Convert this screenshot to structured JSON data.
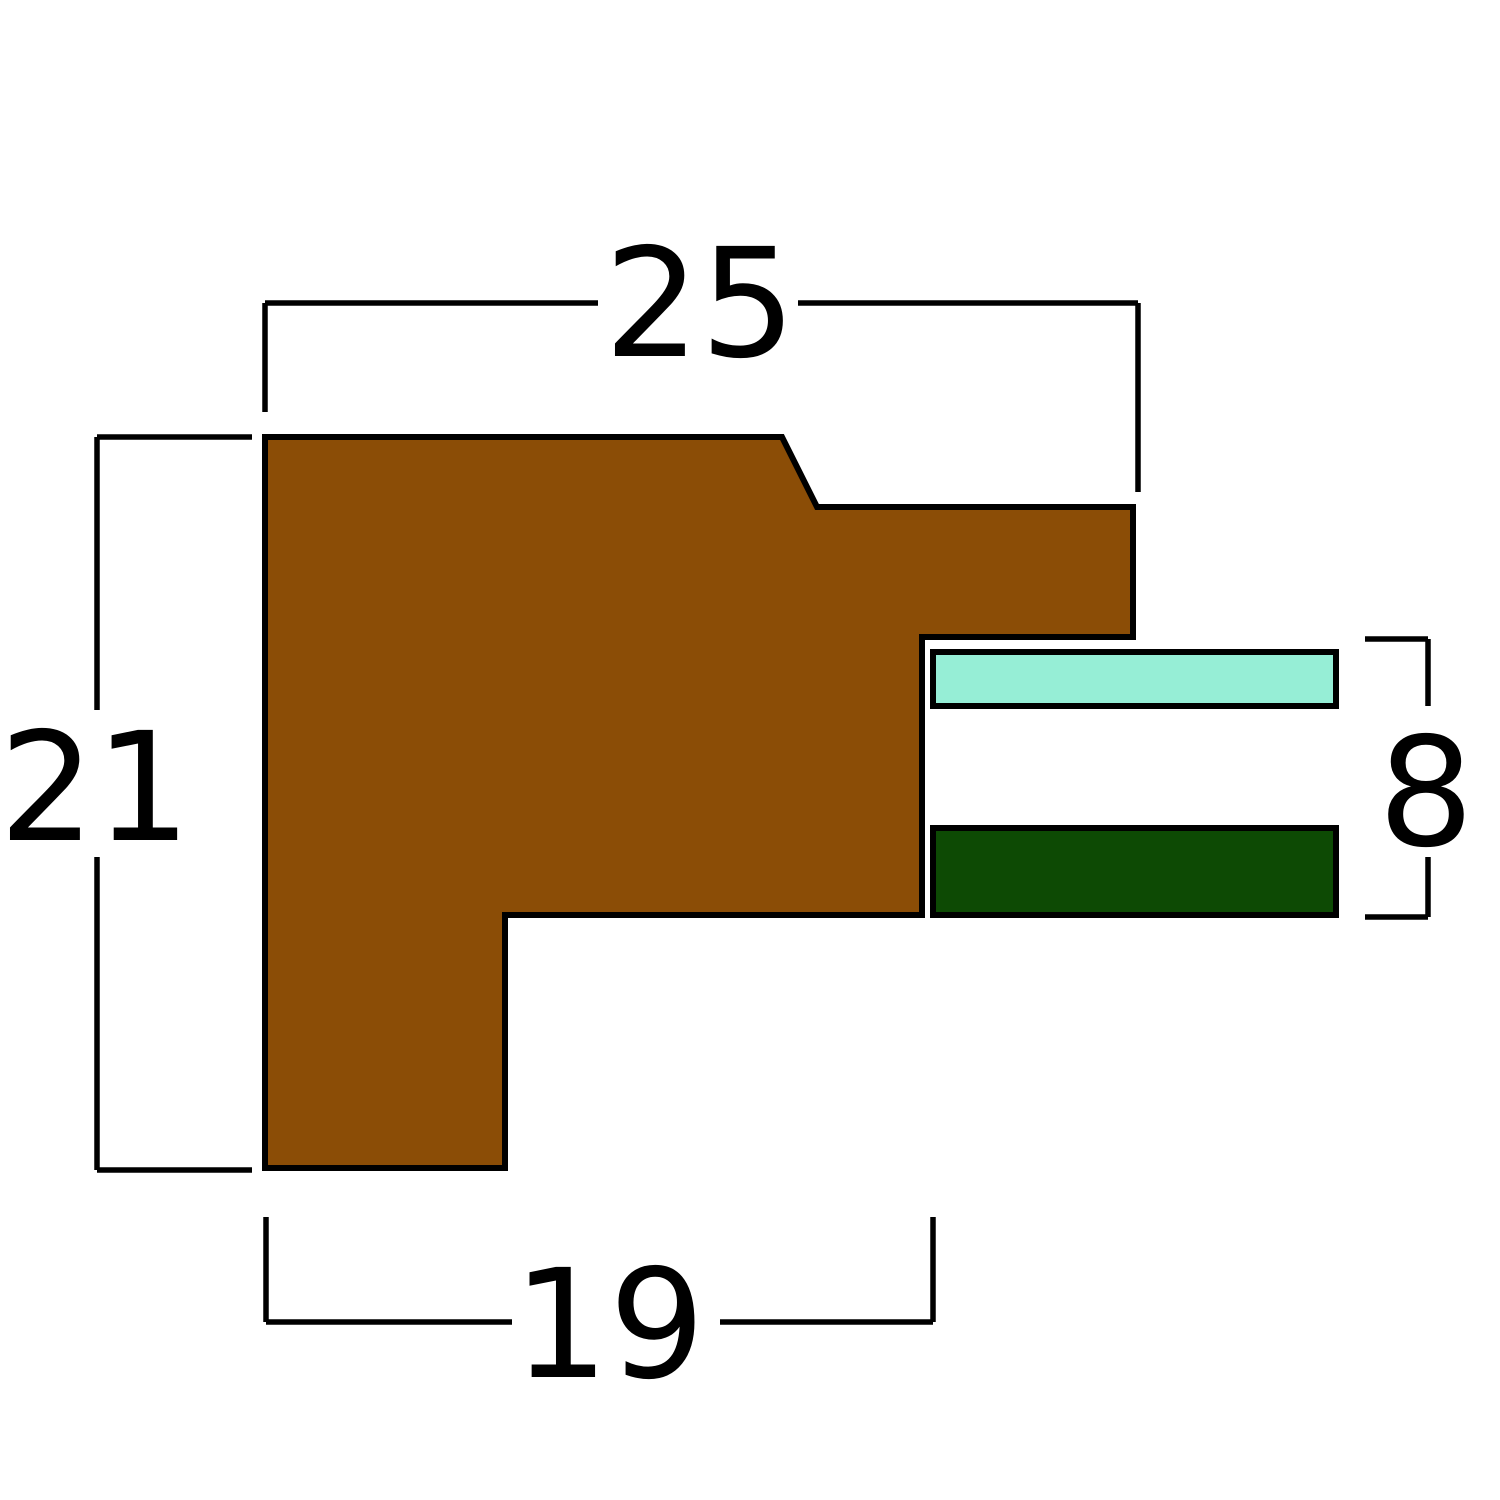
{
  "figure": {
    "kind": "technical cross-section drawing",
    "background": "#ffffff",
    "stroke_color": "#000000"
  },
  "profile": {
    "semantic": "frame-moulding-cross-section",
    "fill": "#8B4D06",
    "points": "265,437 782,437 817,507 1133,507 1133,637 922,637 922,915 505,915 505,1168 265,1168"
  },
  "bars": {
    "glass": {
      "x": 933,
      "y": 652,
      "width": 403,
      "height": 54,
      "fill": "#96EED6"
    },
    "backing": {
      "x": 933,
      "y": 828,
      "width": 403,
      "height": 87,
      "fill": "#0D4A04"
    }
  },
  "dimensions": {
    "width": {
      "label": "25",
      "label_pos": [
        700,
        356
      ],
      "line_a": [
        265,
        303,
        598,
        303
      ],
      "line_b": [
        798,
        303,
        1138,
        303
      ],
      "tick_a": [
        265,
        303,
        265,
        412
      ],
      "tick_b": [
        1138,
        303,
        1138,
        492
      ]
    },
    "height": {
      "label": "21",
      "label_pos": [
        95,
        840
      ],
      "line_a": [
        97,
        437,
        97,
        710
      ],
      "line_b": [
        97,
        857,
        97,
        1170
      ],
      "tick_a": [
        97,
        437,
        252,
        437
      ],
      "tick_b": [
        97,
        1170,
        252,
        1170
      ]
    },
    "rabbet": {
      "label": "19",
      "label_pos": [
        609,
        1377
      ],
      "line_a": [
        266,
        1322,
        512,
        1322
      ],
      "line_b": [
        720,
        1322,
        933,
        1322
      ],
      "tick_a": [
        266,
        1217,
        266,
        1322
      ],
      "tick_b": [
        933,
        1217,
        933,
        1322
      ]
    },
    "stack": {
      "label": "8",
      "label_pos": [
        1426,
        845
      ],
      "line_a": [
        1428,
        639,
        1428,
        706
      ],
      "line_b": [
        1428,
        857,
        1428,
        917
      ],
      "tick_a": [
        1365,
        639,
        1428,
        639
      ],
      "tick_b": [
        1365,
        917,
        1428,
        917
      ]
    }
  }
}
